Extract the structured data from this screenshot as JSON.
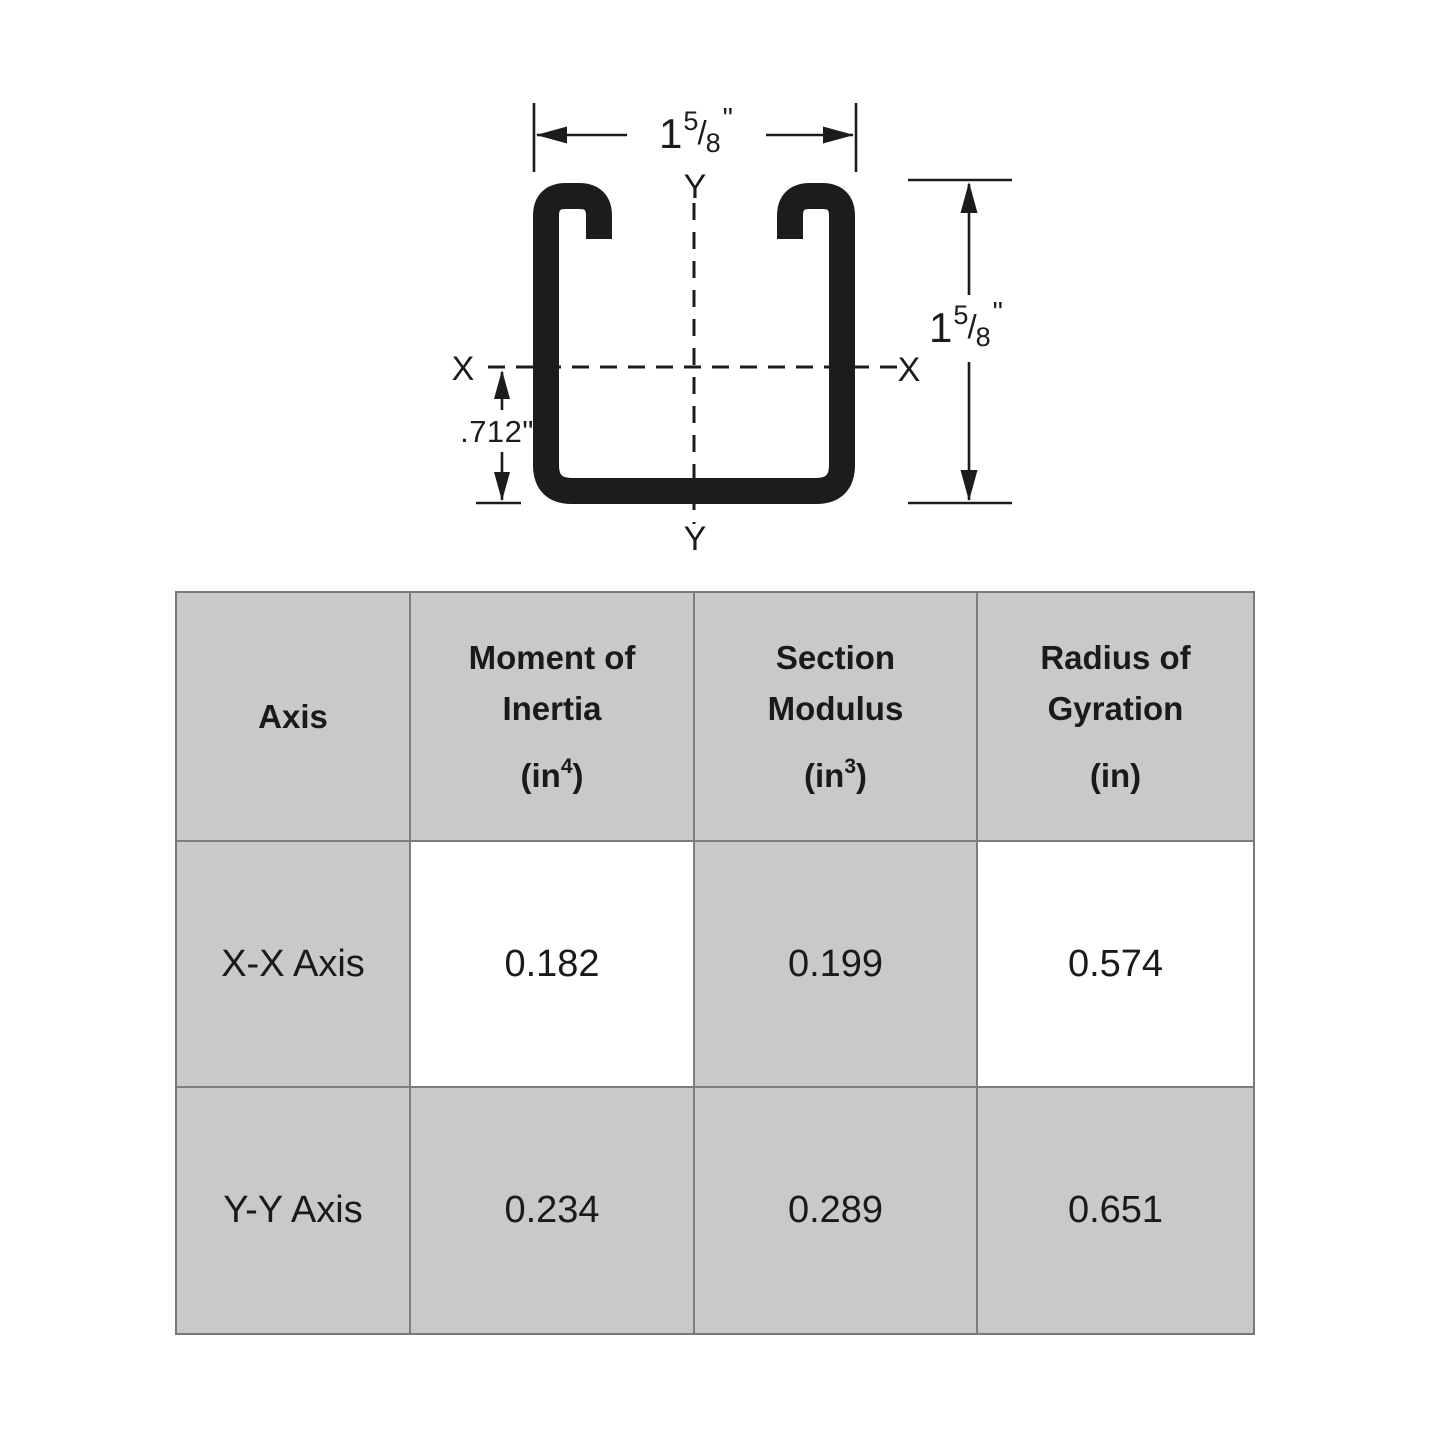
{
  "diagram": {
    "width_dimension": {
      "whole": "1",
      "numerator": "5",
      "separator": "/",
      "denominator": "8",
      "unit": "\""
    },
    "height_dimension": {
      "whole": "1",
      "numerator": "5",
      "separator": "/",
      "denominator": "8",
      "unit": "\""
    },
    "centroid_offset": ".712\"",
    "axes": {
      "x_left": "X",
      "x_right": "X",
      "y_top": "Y",
      "y_bottom": "Y"
    }
  },
  "table": {
    "header": {
      "axis": "Axis",
      "moment": {
        "line1": "Moment of",
        "line2": "Inertia",
        "unit_base": "(in",
        "unit_sup": "4",
        "unit_close": ")"
      },
      "section": {
        "line1": "Section",
        "line2": "Modulus",
        "unit_base": "(in",
        "unit_sup": "3",
        "unit_close": ")"
      },
      "radius": {
        "line1": "Radius of",
        "line2": "Gyration",
        "unit_base": "(in",
        "unit_sup": "",
        "unit_close": ")"
      }
    },
    "rows": [
      {
        "axis": "X-X Axis",
        "moment_of_inertia": "0.182",
        "section_modulus": "0.199",
        "radius_of_gyration": "0.574"
      },
      {
        "axis": "Y-Y Axis",
        "moment_of_inertia": "0.234",
        "section_modulus": "0.289",
        "radius_of_gyration": "0.651"
      }
    ]
  },
  "colors": {
    "line": "#1c1c1c",
    "table_gray": "#c9c9c9",
    "table_border": "#7d7d7d",
    "text": "#1a1a1a"
  }
}
